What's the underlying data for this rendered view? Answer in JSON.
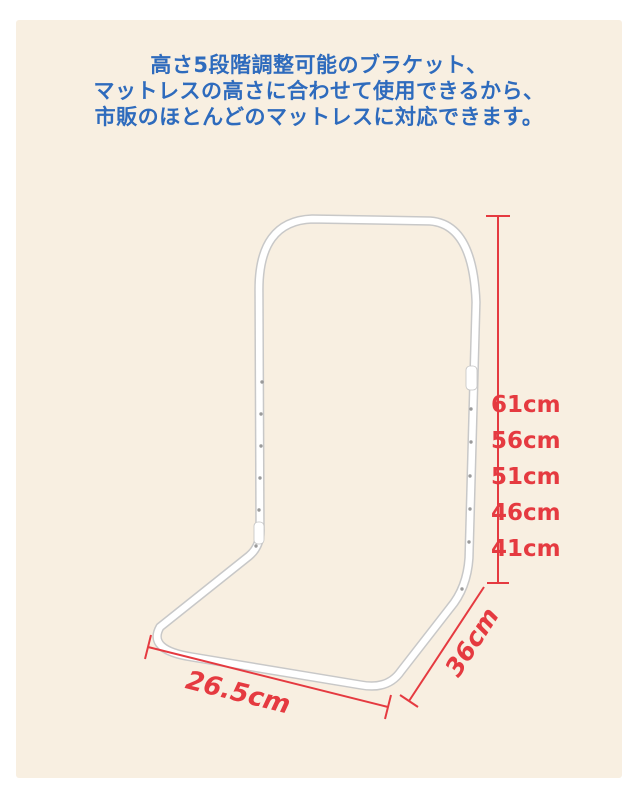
{
  "panel": {
    "background_color": "#f8efe1",
    "border_color": "#ffffff"
  },
  "caption": {
    "color": "#2e6bbd",
    "lines": [
      "高さ5段階調整可能のブラケット、",
      "マットレスの高さに合わせて使用できるから、",
      "市販のほとんどのマットレスに対応できます。"
    ]
  },
  "product": {
    "name": "height-adjustable bed rail bracket frame",
    "tube_color": "#ffffff",
    "tube_outline_color": "#c8c8c8",
    "adjustment_levels": 5
  },
  "dimensions": {
    "color": "#e53a40",
    "heights": [
      {
        "label": "61cm"
      },
      {
        "label": "56cm"
      },
      {
        "label": "51cm"
      },
      {
        "label": "46cm"
      },
      {
        "label": "41cm"
      }
    ],
    "depth_label": "36cm",
    "width_label": "26.5cm"
  }
}
